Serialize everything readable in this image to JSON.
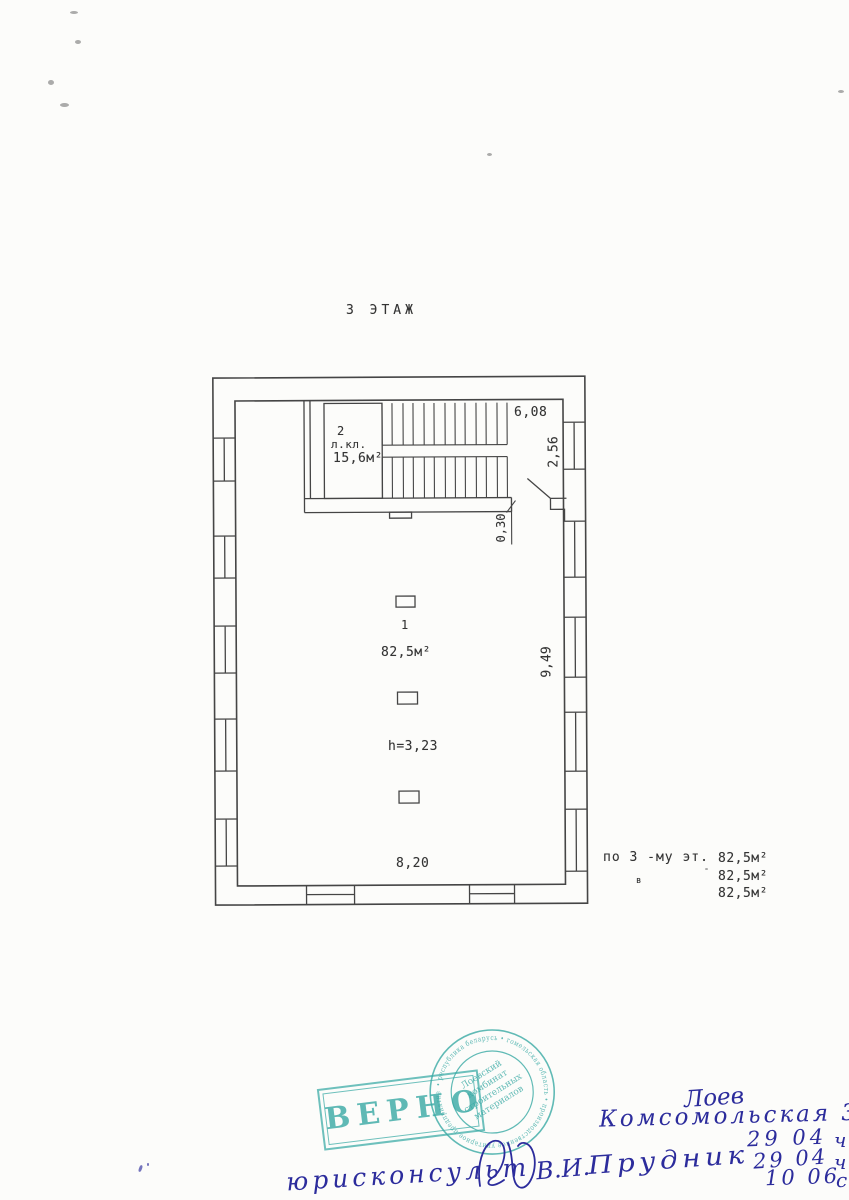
{
  "document": {
    "title": "3 ЭТАЖ"
  },
  "plan": {
    "stair_room": {
      "number": "2",
      "label": "л.кл.",
      "area": "15,6м²"
    },
    "main_room": {
      "number": "1",
      "area": "82,5м²",
      "height_note": "h=3,23"
    },
    "dimensions": {
      "top_width": "6,08",
      "vestibule_depth": "2,56",
      "wall_thickness": "0,30",
      "room_depth": "9,49",
      "room_width": "8,20"
    }
  },
  "summary": {
    "caption": "по 3 -му эт.",
    "small_mark": "в",
    "areas": [
      "82,5м²",
      "82,5м²",
      "82,5м²"
    ]
  },
  "stamps": {
    "approval": {
      "text": "ВЕРНО",
      "color": "#3aaaa5"
    },
    "round_seal": {
      "ring_text": "• республика беларусь • гомельская область • производственное унитарное предприятие",
      "center_lines": [
        "Лоевский",
        "комбинат",
        "строительных",
        "материалов"
      ],
      "color": "#3aaaa5"
    }
  },
  "handwriting": {
    "ink_color": "#2c2c9c",
    "city": "Лоев",
    "street": "Комсомольская 33",
    "date_rows": [
      "29 04",
      "29 04",
      "10 06"
    ],
    "edge_marks": [
      "ч",
      "ч",
      "с"
    ],
    "signature_line": {
      "role": "юрисконсульт",
      "initials": "В.И.",
      "surname": "Прудник"
    }
  }
}
